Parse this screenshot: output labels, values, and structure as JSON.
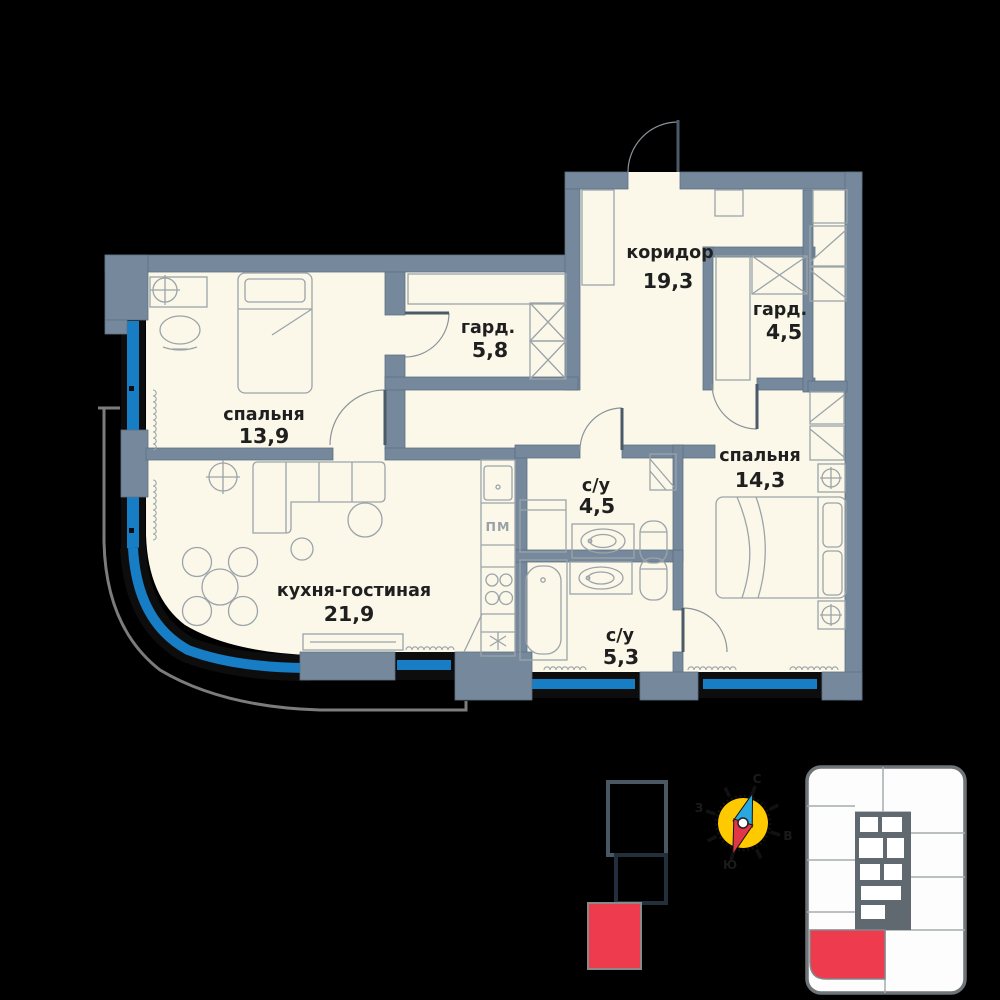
{
  "plan": {
    "rooms": {
      "bedroom1": {
        "label": "спальня",
        "area": "13,9"
      },
      "wardrobe1": {
        "label": "гард.",
        "area": "5,8"
      },
      "corridor": {
        "label": "коридор",
        "area": "19,3"
      },
      "wardrobe2": {
        "label": "гард.",
        "area": "4,5"
      },
      "bedroom2": {
        "label": "спальня",
        "area": "14,3"
      },
      "bath1": {
        "label": "с/у",
        "area": "4,5"
      },
      "bath2": {
        "label": "с/у",
        "area": "5,3"
      },
      "kitchen_living": {
        "label": "кухня-гостиная",
        "area": "21,9"
      }
    },
    "appliances": {
      "dishwasher": "ПМ"
    }
  },
  "compass": {
    "north": "С",
    "east": "В",
    "south": "Ю",
    "west": "З"
  },
  "colors": {
    "wall": "#76889B",
    "floor": "#FBF8EA",
    "window_glass": "#177DC5",
    "window_frame": "#0D0D0D",
    "balcony_line": "#7C7C7C",
    "highlight_red": "#EE3B4D",
    "compass_yellow": "#FFC900",
    "needle_blue": "#29A8DF",
    "needle_red": "#E13548"
  }
}
